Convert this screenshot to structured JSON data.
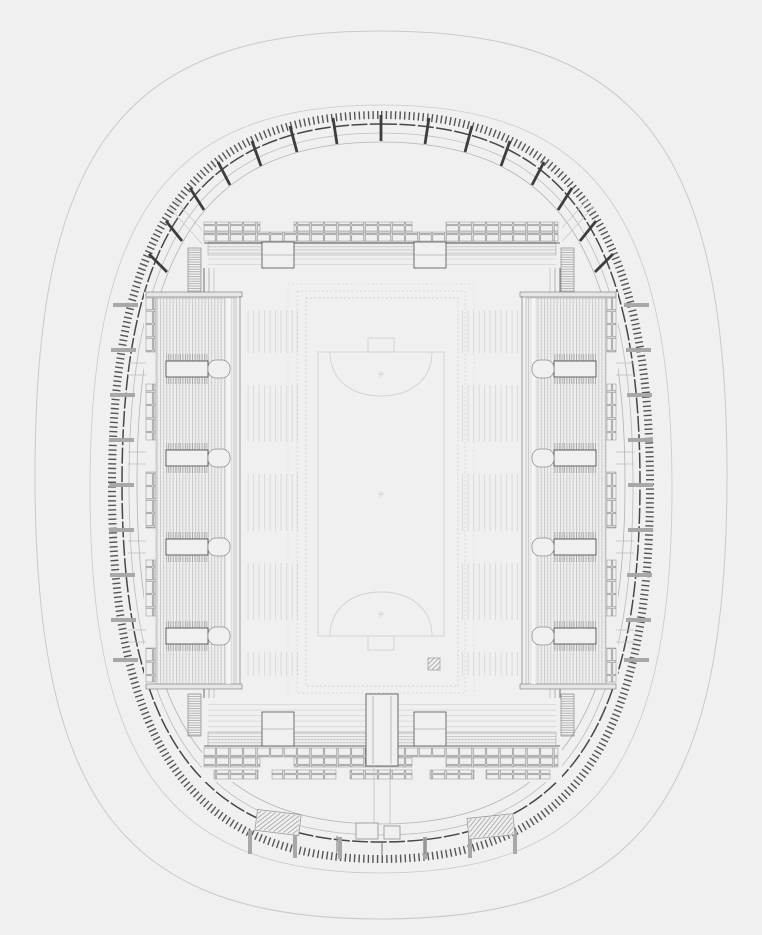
{
  "meta": {
    "kind": "architectural-plan",
    "subject": "stadium-bowl-and-roof-plan",
    "orientation": "portrait"
  },
  "palette": {
    "background": "#f0f0f1",
    "site_outline": "#c9c9c9",
    "roof_tick": "#555555",
    "roof_edge": "#474747",
    "roof_mid": "#bcbcbc",
    "roof_inner": "#b3b3b3",
    "truss": "#3d3d3d",
    "column_tick": "#a8a8a8",
    "bowl_frame": "#7d7d7d",
    "stand_line": "#a0a0a0",
    "stand_dark": "#4f4f4f",
    "box_line": "#8e8e8e",
    "faint_tier": "#d9d9d9",
    "walkway": "#f5f5f5",
    "hatch": "#919191",
    "field_line": "#d6d1cb",
    "gate_line": "#9a9a9a",
    "connector": "#bdbdbd"
  },
  "roof": {
    "truss_count": 15,
    "tick_style": "serrated",
    "column_tick_rows": 24
  },
  "bowl": {
    "side_vomitories_per_stand": 4,
    "end_vomitories_per_stand": 2,
    "corner_stairs": 4,
    "box_rows_north": 2,
    "box_rows_south": 3,
    "players_tunnel": true
  },
  "field": {
    "type": "pitch",
    "markings": [
      "goal-box-north",
      "goal-arc-north",
      "penalty-mark-north",
      "goal-box-south",
      "goal-arc-south",
      "penalty-mark-south",
      "center-mark",
      "surveyor-grid-mark"
    ]
  },
  "site": {
    "bottom_gates": 2,
    "kiosks": 2
  }
}
